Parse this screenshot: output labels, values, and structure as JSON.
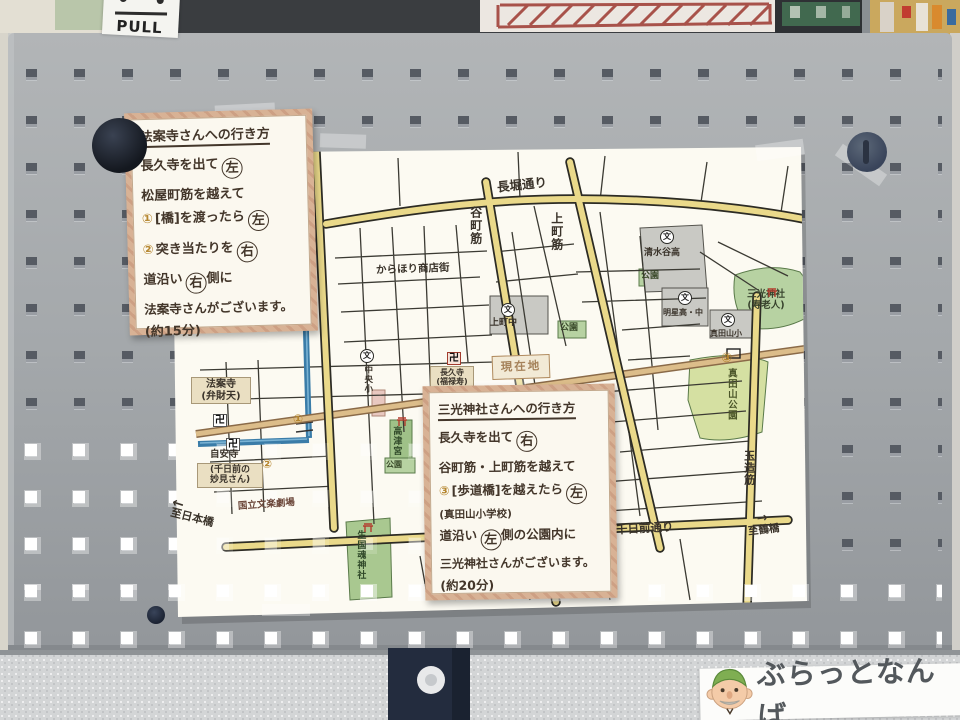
{
  "background": {
    "pull_sign": "PULL"
  },
  "notes": {
    "hoanji": {
      "title": "法案寺さんへの行き方",
      "l1_pre": "長久寺を出て",
      "l1_circle": "左",
      "l2": "松屋町筋を越えて",
      "l3_num": "①",
      "l3_pre": "[橋]を渡ったら",
      "l3_circle": "左",
      "l4_num": "②",
      "l4_pre": "突き当たりを",
      "l4_circle": "右",
      "l5_pre": "道沿い",
      "l5_circle": "右",
      "l5_post": "側に",
      "l6": "法案寺さんがございます。",
      "l7": "(約15分)"
    },
    "sanko": {
      "title": "三光神社さんへの行き方",
      "l1_pre": "長久寺を出て",
      "l1_circle": "右",
      "l2": "谷町筋・上町筋を越えて",
      "l3_num": "③",
      "l3_pre": "[歩道橋]を越えたら",
      "l3_circle": "左",
      "l4": "(真田山小学校)",
      "l5_pre": "道沿い",
      "l5_circle": "左",
      "l5_post": "側の公園内に",
      "l6": "三光神社さんがございます。",
      "l7": "(約20分)"
    }
  },
  "map": {
    "streets": {
      "nagahori": "長堀通り",
      "tanimachi": "谷町筋",
      "uemachi": "上町筋",
      "matsuyamachi": "松屋町筋",
      "tamatsukuri": "玉造筋",
      "sennichimae": "千日前通り",
      "karahori": "からほり商店街"
    },
    "places": {
      "genzaichi": "現在地",
      "hoanji": "法案寺\n(弁財天)",
      "jianji": "自安寺",
      "jianji_note": "(千日前の\n妙見さん)",
      "chokyuji": "長久寺\n(福禄寿)",
      "kozu": "高津宮",
      "ikukunitama": "生国魂神社",
      "sanko": "三光神社\n(寿老人)",
      "park": "公園",
      "sanadayama_park": "真田山公園",
      "chuo_es": "中央小",
      "uemachi_jh": "上町中",
      "shimizudani_hs": "清水谷高",
      "meisei": "明星高・中",
      "sanadayama_es": "真田山小",
      "bunraku": "国立文楽劇場",
      "to_nipponbashi": "至日本橋",
      "to_tsuruhashi": "至鶴橋"
    },
    "marks": {
      "school": "文",
      "manji": "卍",
      "m1": "①",
      "m2": "②",
      "m3": "③",
      "arrow_left": "←",
      "arrow_right": "→"
    }
  },
  "logo": {
    "text": "ぶらっとなんば"
  }
}
